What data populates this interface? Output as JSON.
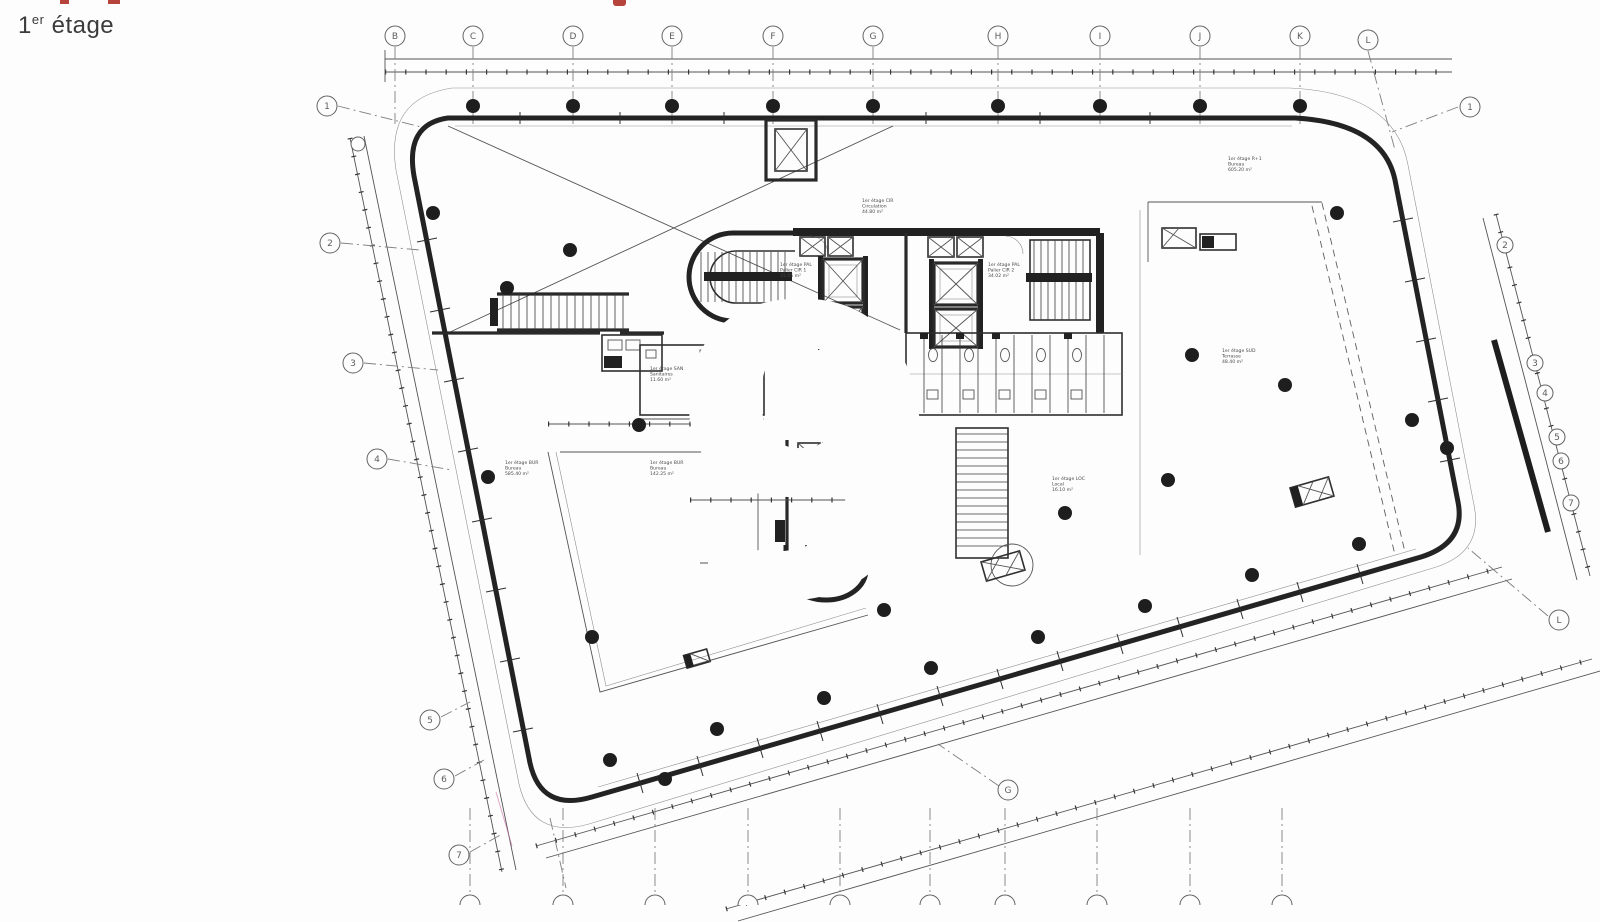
{
  "page": {
    "title_base": "1",
    "title_sup": "er",
    "title_rest": " étage"
  },
  "watermark": "9",
  "axes": {
    "top": [
      "B",
      "C",
      "D",
      "E",
      "F",
      "G",
      "H",
      "I",
      "J",
      "K",
      "L"
    ],
    "left": [
      "1",
      "2",
      "3",
      "4",
      "5",
      "6",
      "7"
    ],
    "right_top": "1",
    "right_chain": [
      "2",
      "3",
      "4",
      "5",
      "6",
      "7"
    ],
    "right_bottom": "L",
    "bottom_mid": "G"
  },
  "rooms": {
    "circulation": [
      "1er étage CIR",
      "Circulation",
      "44.80 m²"
    ],
    "lobby1": [
      "1er étage PAL",
      "Palier CIR 1",
      "31.05 m²"
    ],
    "lobby2": [
      "1er étage PAL",
      "Palier CIR 2",
      "34.02 m²"
    ],
    "sanitaires": [
      "1er étage SAN",
      "Sanitaires",
      "11.60 m²"
    ],
    "wc": [
      "1er étage SAN",
      "WC",
      "6.85 m²"
    ],
    "bureau_left": [
      "1er étage BUR",
      "Bureau",
      "585.40 m²"
    ],
    "bureau_mid": [
      "1er étage BUR",
      "Bureau",
      "142.25 m²"
    ],
    "lobby3": [
      "1er étage PAL",
      "Palier CIR 3",
      "8.85 m²"
    ],
    "local": [
      "1er étage LOC",
      "Local",
      "16.10 m²"
    ],
    "bureau_right": [
      "1er étage R+1",
      "Bureau",
      "605.20 m²"
    ],
    "terrasse": [
      "1er étage SUD",
      "Terrasse",
      "48.40 m²"
    ]
  },
  "colors": {
    "ink": "#161616",
    "line": "#4a4a4a",
    "paper": "#fdfdfd",
    "red": "#b5443c"
  }
}
